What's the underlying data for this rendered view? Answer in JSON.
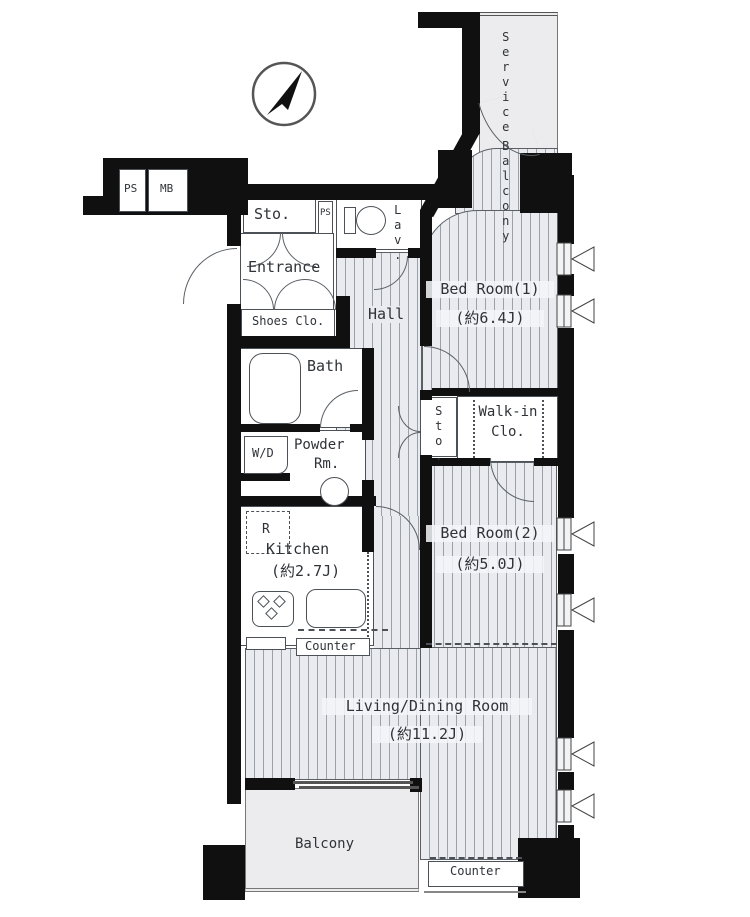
{
  "labels": {
    "service_w1": "Service",
    "service_w2": "Balcony",
    "ps": "PS",
    "mb": "MB",
    "sto_entry": "Sto.",
    "ps_small": "PS",
    "lav": "Lav.",
    "entrance": "Entrance",
    "shoes_closet": "Shoes Clo.",
    "hall": "Hall",
    "bath": "Bath",
    "washer_dryer": "W/D",
    "powder_l1": "Powder",
    "powder_l2": "Rm.",
    "bedroom1_name": "Bed Room(1)",
    "bedroom1_size": "(約6.4J)",
    "sto_hall": "Sto.",
    "walkin_l1": "Walk-in",
    "walkin_l2": "Clo.",
    "bedroom2_name": "Bed Room(2)",
    "bedroom2_size": "(約5.0J)",
    "kitchen_name": "Kitchen",
    "kitchen_size": "(約2.7J)",
    "fridge": "R",
    "kitchen_counter": "Counter",
    "living_name": "Living/Dining Room",
    "living_size": "(約11.2J)",
    "balcony": "Balcony",
    "living_counter": "Counter"
  },
  "colors": {
    "wall": "#101010",
    "line": "#555555",
    "floor_fill": "#e9ebef",
    "stripe": "#9aa1ab",
    "balcony_fill": "#ececee",
    "text": "#2f3338"
  },
  "compass": {
    "icon": "north-arrow"
  }
}
